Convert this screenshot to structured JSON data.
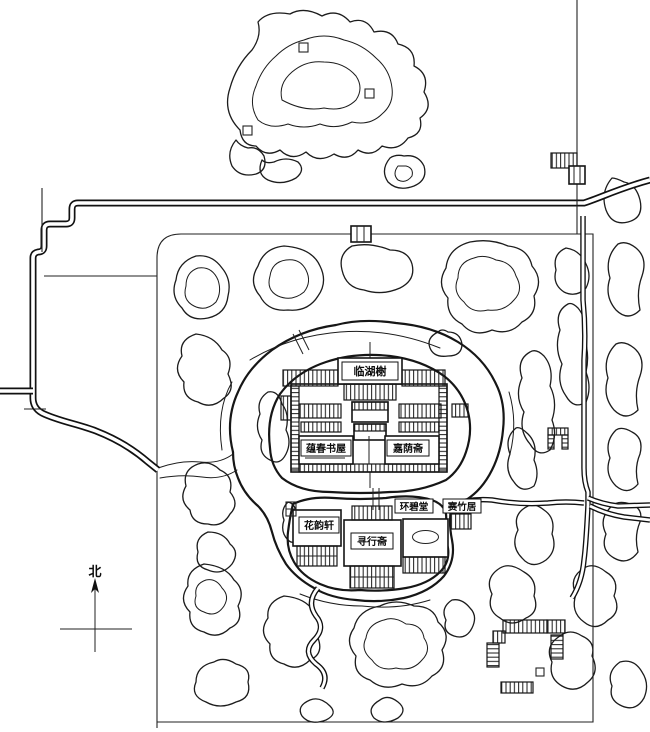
{
  "colors": {
    "ink": "#1a1a1a",
    "paper": "#ffffff"
  },
  "compass": {
    "north_label": "北"
  },
  "buildings": {
    "north_waterside_pavilion": "临湖榭",
    "west_study": "蕴春书屋",
    "east_studio": "嘉荫斋",
    "middle_hall": "环碧堂",
    "bamboo_cottage": "赛竹居",
    "flower_pavilion": "花韵轩",
    "south_studio": "寻行斋"
  }
}
